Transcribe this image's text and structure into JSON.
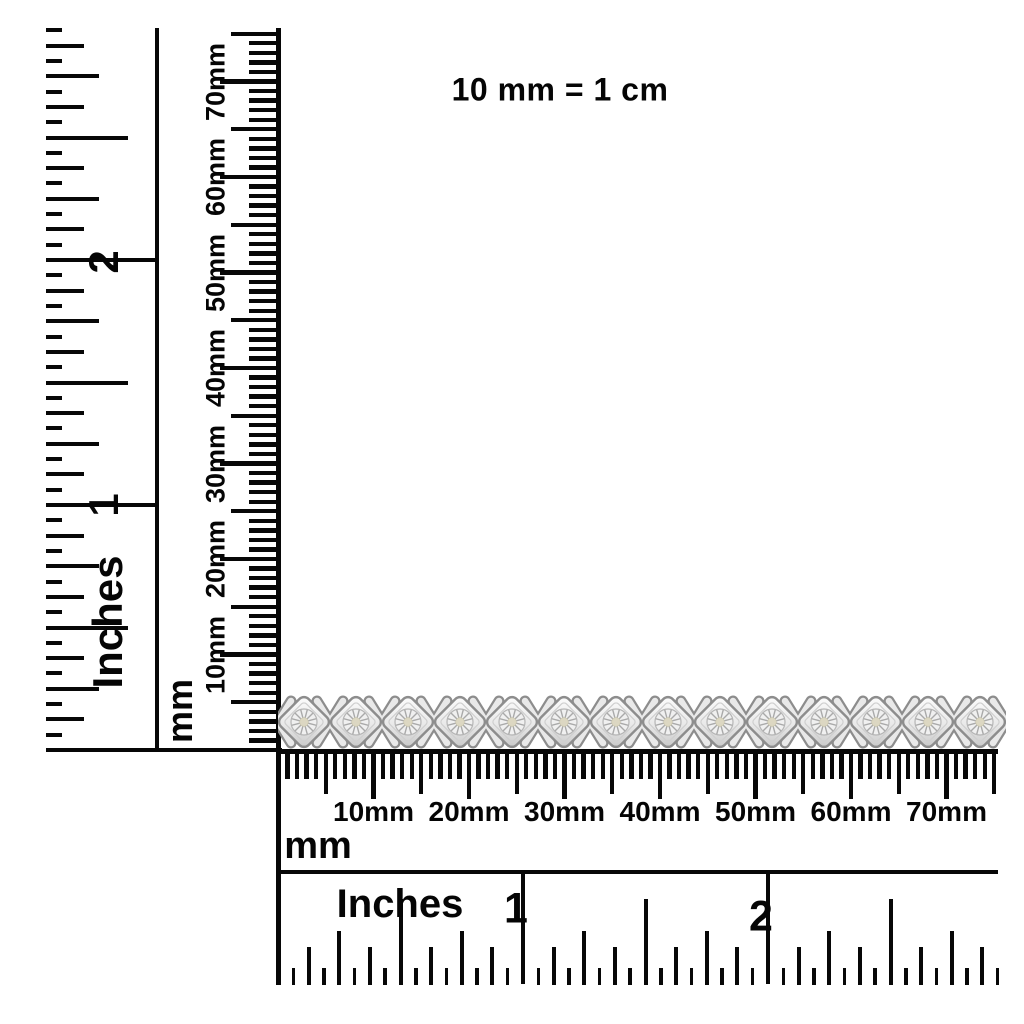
{
  "note": {
    "text": "10 mm = 1 cm"
  },
  "left_inches_ruler": {
    "unit_label": "Inches",
    "labels": [
      "1",
      "2"
    ]
  },
  "vertical_mm_ruler": {
    "unit_label": "mm",
    "labels": [
      "10mm",
      "20mm",
      "30mm",
      "40mm",
      "50mm",
      "60mm",
      "70mm"
    ]
  },
  "horizontal_mm_ruler": {
    "unit_label": "mm",
    "labels": [
      "10mm",
      "20mm",
      "30mm",
      "40mm",
      "50mm",
      "60mm",
      "70mm"
    ]
  },
  "bottom_inches_ruler": {
    "unit_label": "Inches",
    "labels": [
      "1",
      "2"
    ]
  },
  "bracelet": {
    "description": "silver diamond X-link tennis bracelet",
    "link_count": 14,
    "colors": {
      "metal_light": "#fdfdfd",
      "metal_mid": "#c6c6c6",
      "metal_dark": "#8d8d8d",
      "metal_band": "#e9e9e9",
      "stone_face": "#f0f0f0",
      "stone_lines": "#a9a9a9",
      "stone_center": "#dcd7c2"
    }
  },
  "colors": {
    "ink": "#070707",
    "background": "#ffffff"
  }
}
